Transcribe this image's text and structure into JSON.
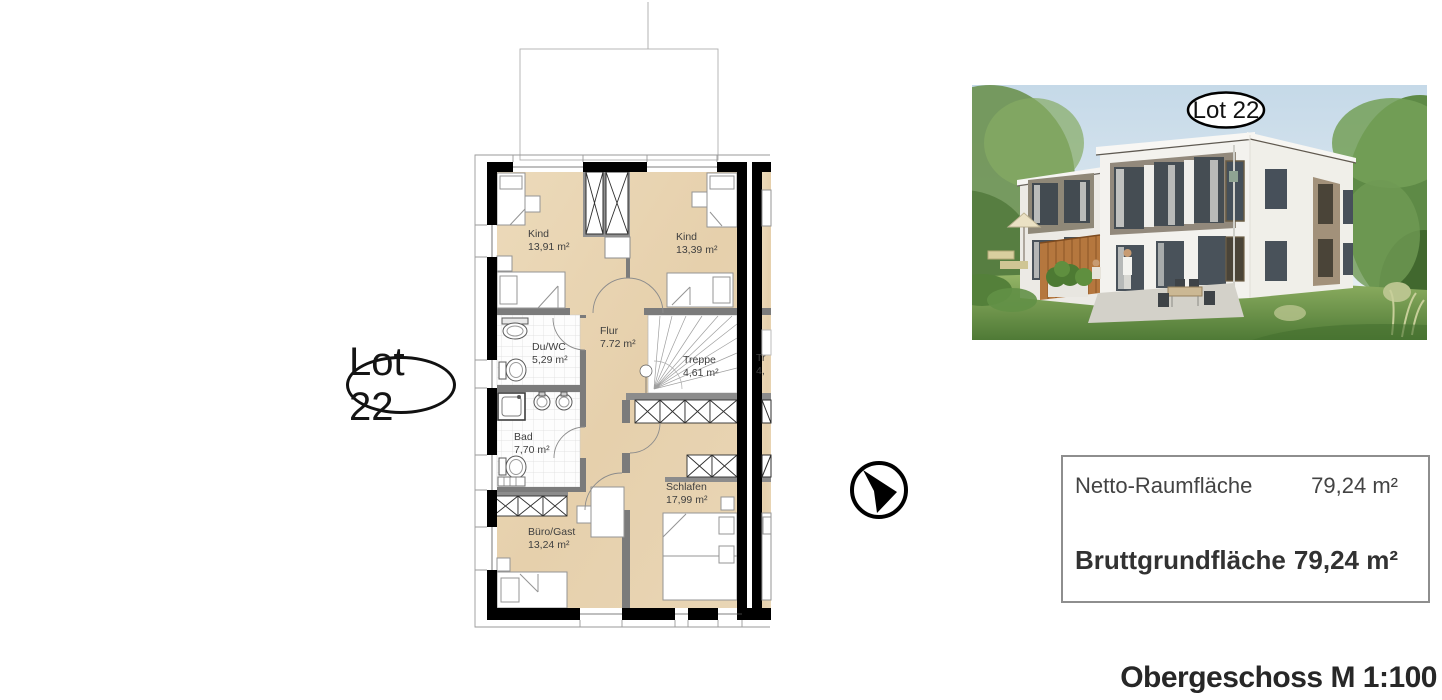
{
  "floor_plan": {
    "lot_badge": "Lot 22",
    "rooms": [
      {
        "id": "kind_left",
        "name": "Kind",
        "area": "13,91 m²"
      },
      {
        "id": "kind_right",
        "name": "Kind",
        "area": "13,39 m²"
      },
      {
        "id": "flur",
        "name": "Flur",
        "area": "7.72 m²"
      },
      {
        "id": "duwc",
        "name": "Du/WC",
        "area": "5,29 m²"
      },
      {
        "id": "treppe",
        "name": "Treppe",
        "area": "4,61 m²"
      },
      {
        "id": "bad",
        "name": "Bad",
        "area": "7,70 m²"
      },
      {
        "id": "buero_gast",
        "name": "Büro/Gast",
        "area": "13,24 m²"
      },
      {
        "id": "schlafen",
        "name": "Schlafen",
        "area": "17,99 m²"
      }
    ],
    "neighbor_unit_clipped": {
      "name": "Tr",
      "area": "4,"
    }
  },
  "rendering": {
    "lot_badge": "Lot 22"
  },
  "area_table": {
    "rows": [
      {
        "label": "Netto-Raumfläche",
        "value": "79,24 m²"
      },
      {
        "label": "Bruttgrundfläche",
        "value": "79,24 m²"
      }
    ]
  },
  "caption": "Obergeschoss M 1:100",
  "colors": {
    "floor_wood": "#e9d6b6",
    "wall_black": "#000000",
    "partition_gray": "#7b7b7b",
    "sky_blue": "#c5d9e8",
    "grass_green": "#4f7a36",
    "fence_wood": "#b5773e",
    "facade_white": "#f3f2ee",
    "accent_panel_tan": "#a2917a"
  }
}
